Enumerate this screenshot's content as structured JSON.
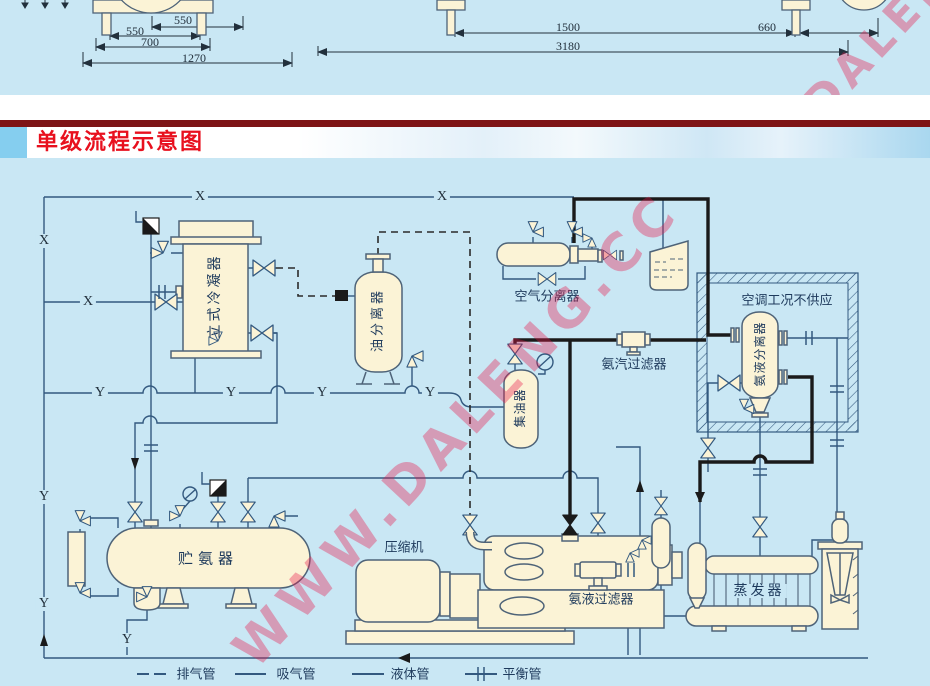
{
  "title": {
    "text": "单级流程示意图"
  },
  "watermark": {
    "text": "WWW.DALENG.CC"
  },
  "dimensions": {
    "d550a": "550",
    "d550b": "550",
    "d700": "700",
    "d1270": "1270",
    "d1500": "1500",
    "d3180": "3180",
    "d660": "660"
  },
  "pipe_labels": {
    "x": "X",
    "y": "Y"
  },
  "equipment": {
    "condenser": "立式冷凝器",
    "oil_separator": "油分离器",
    "air_separator": "空气分离器",
    "vapor_filter": "氨汽过滤器",
    "ac_note": "空调工况不供应",
    "liquid_separator": "氨液分离器",
    "oil_collector": "集油器",
    "receiver": "贮氨器",
    "compressor": "压缩机",
    "liquid_filter": "氨液过滤器",
    "evaporator": "蒸发器"
  },
  "legend": {
    "exhaust": "排气管",
    "suction": "吸气管",
    "liquid": "液体管",
    "balance": "平衡管"
  },
  "colors": {
    "background_blue": "#C9E7F4",
    "vessel_cream": "#FBF3D6",
    "pipe_blue": "#33597F",
    "pipe_black": "#1A1A1A",
    "title_red": "#E8101E",
    "banner_rule_red": "#7E1416",
    "watermark_red": "rgba(234,22,73,0.36)"
  }
}
